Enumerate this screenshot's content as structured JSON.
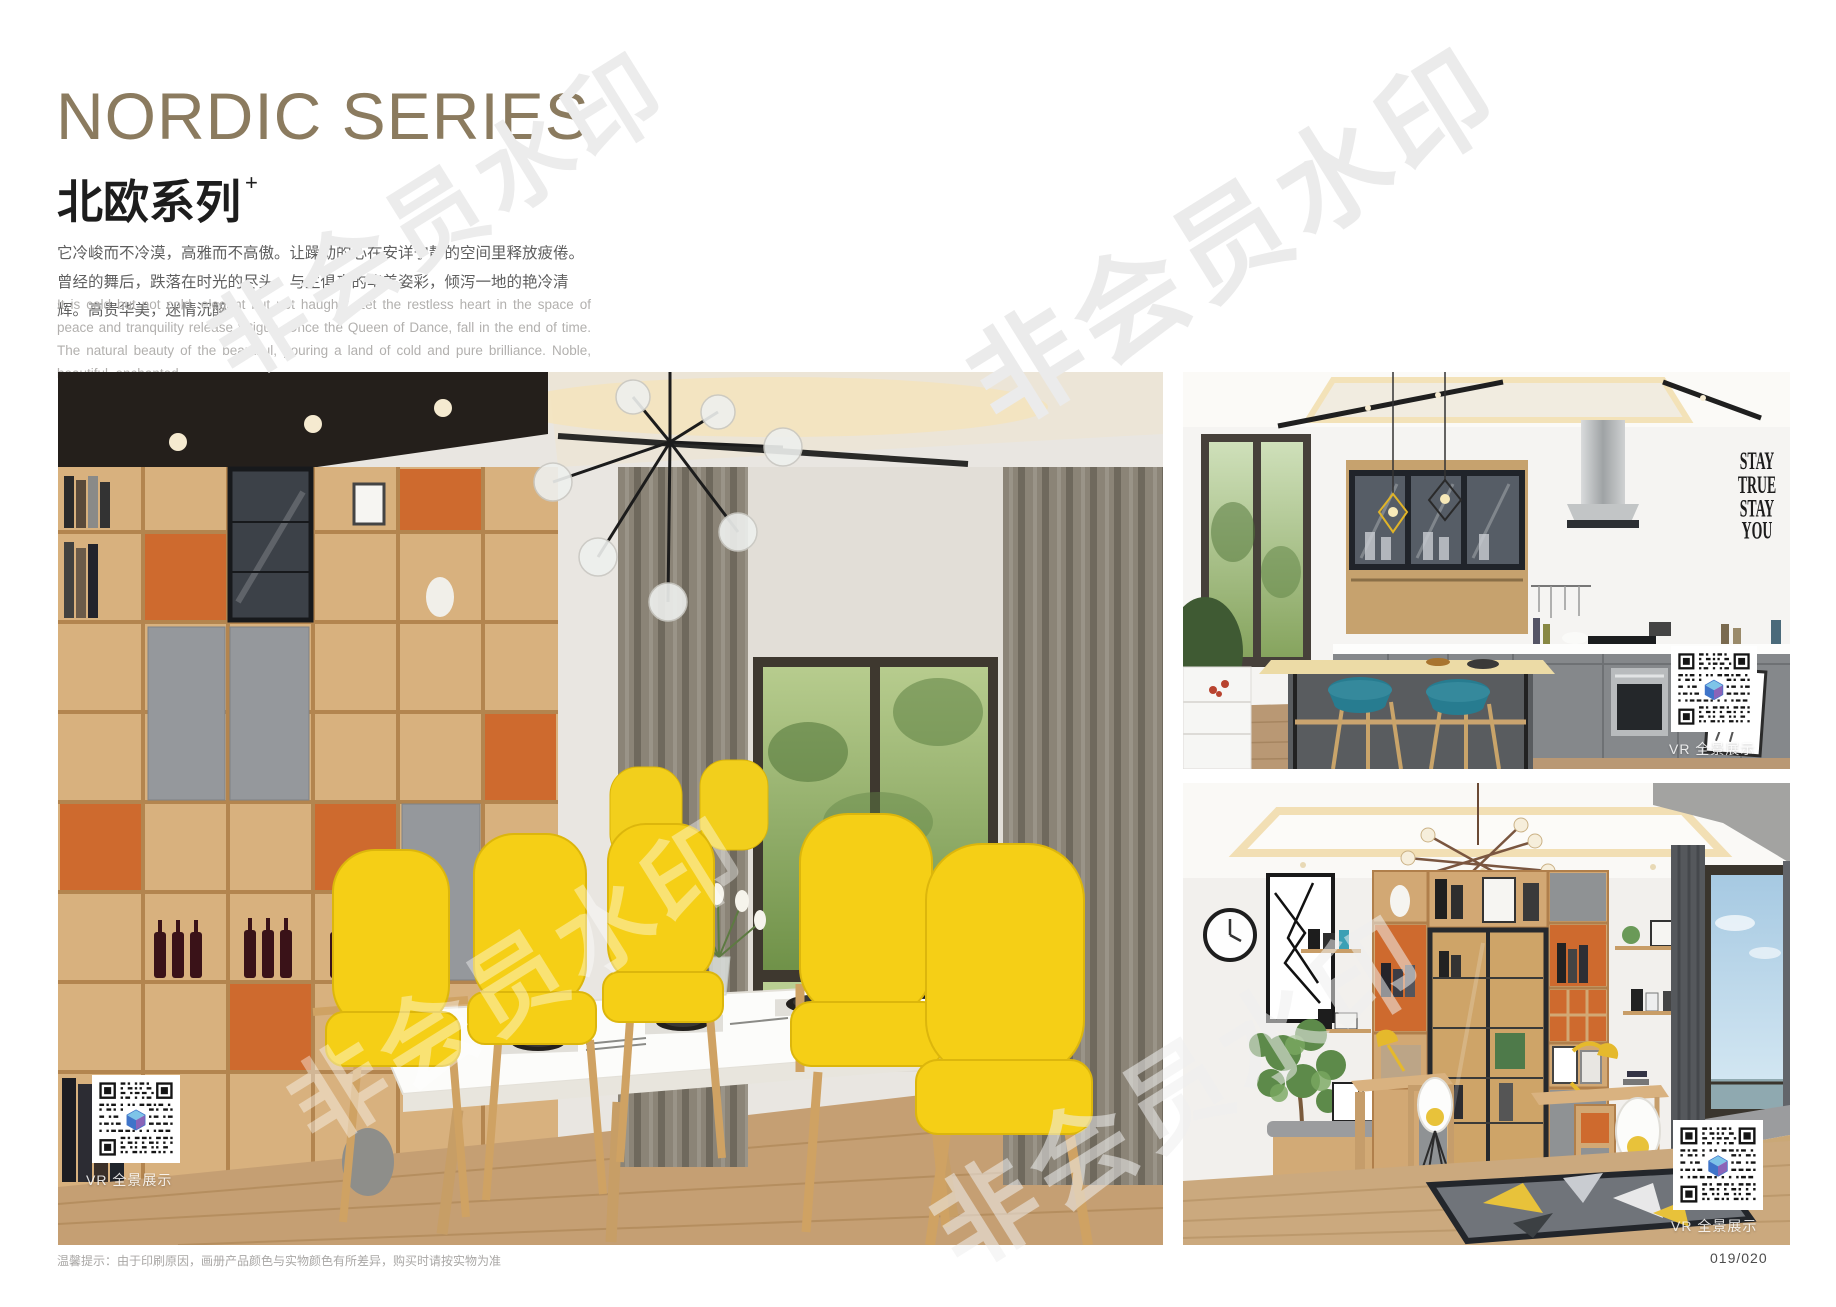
{
  "header": {
    "title_en": "NORDIC SERIES",
    "title_zh": "北欧系列",
    "title_superscript": "+",
    "paragraph_zh": "它冷峻而不冷漠，高雅而不高傲。让躁动的心在安详宁静的空间里释放疲倦。曾经的舞后，跌落在时光的尽头。与生俱来的华美姿彩，倾泻一地的艳冷清辉。高贵华美，迷情沉醉。",
    "paragraph_en": "It is cold but not cold, elegant but not haughty. Let the restless heart in the space of peace and tranquility release fatigue. Once the Queen of Dance, fall in the end of time. The natural beauty of the beautiful, pouring a land of cold and pure brilliance. Noble, beautiful, enchanted."
  },
  "watermark": {
    "text": "非会员水印"
  },
  "photos": {
    "dining_room": {
      "caption": "Nordic dining room with yellow chairs and wine display shelving",
      "vr_label": "VR 全景展示"
    },
    "kitchen": {
      "caption": "Nordic kitchen with island bar and teal stools",
      "vr_label": "VR 全景展示",
      "wall_art_lines": [
        "STAY",
        "TRUE",
        "STAY",
        "YOU"
      ]
    },
    "study": {
      "caption": "Nordic study with display cabinet and twin desks",
      "vr_label": "VR 全景展示"
    }
  },
  "footer": {
    "note": "温馨提示：由于印刷原因，画册产品颜色与实物颜色有所差异，购买时请按实物为准",
    "page_number": "019/020"
  },
  "colors": {
    "title_taupe": "#8b7b5f",
    "accent_orange": "#ce6a2e",
    "chair_yellow": "#f5cf16",
    "stool_teal": "#277c90",
    "cabinet_gray": "#8f9294",
    "wood": "#d2a874",
    "napkin_teal": "#1e5a56"
  }
}
